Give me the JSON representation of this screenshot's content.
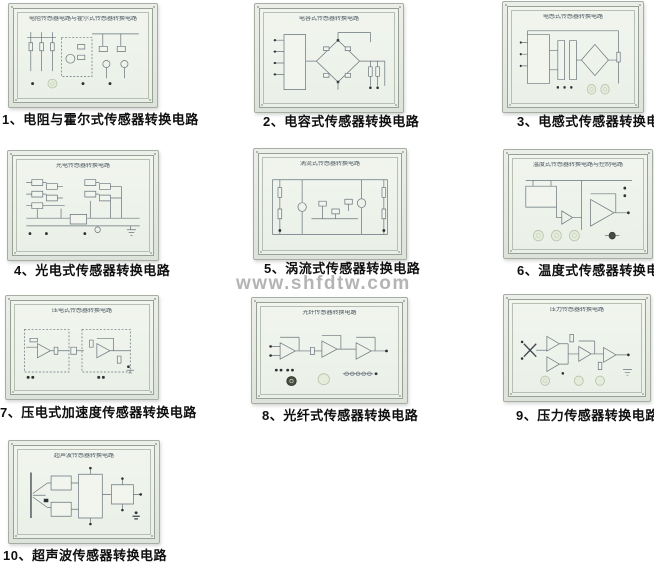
{
  "page": {
    "watermark": "www.shfdtw.com",
    "background": "#ffffff"
  },
  "colors": {
    "panel_frame": "#e3e8e0",
    "panel_face": "#eef2ec",
    "panel_border": "#97a195",
    "schematic_line": "#68737c",
    "caption_text": "#0f0f0f",
    "watermark_text": "#b4b4b4",
    "knob_fill": "#e6ecdb",
    "dark_knob_fill": "#474d41",
    "terminal_dot": "#2e3237"
  },
  "panels": [
    {
      "num": 1,
      "title": "电阻传感器电路与霍尔式传感器转换电路",
      "label": "1、电阻与霍尔式传感器转换电路",
      "schematic": "resistance-hall-circuit"
    },
    {
      "num": 2,
      "title": "电容式传感器转换电路",
      "label": "2、电容式传感器转换电路",
      "schematic": "capacitive-bridge-circuit"
    },
    {
      "num": 3,
      "title": "电感式传感器转换电路",
      "label": "3、电感式传感器转换电路",
      "schematic": "inductive-bridge-circuit"
    },
    {
      "num": 4,
      "title": "光电传感器转换电路",
      "label": "4、光电式传感器转换电路",
      "schematic": "photoelectric-gate-circuit"
    },
    {
      "num": 5,
      "title": "涡流式传感器转换电路",
      "label": "5、涡流式传感器转换电路",
      "schematic": "eddy-current-circuit"
    },
    {
      "num": 6,
      "title": "温度式传感器转换电路与控制电路",
      "label": "6、温度式传感器转换电路",
      "schematic": "temperature-control-circuit"
    },
    {
      "num": 7,
      "title": "压电式传感器转换电路",
      "label": "7、压电式加速度传感器转换电路",
      "schematic": "piezoelectric-amp-circuit"
    },
    {
      "num": 8,
      "title": "光纤传感器转换电路",
      "label": "8、光纤式传感器转换电路",
      "schematic": "fiber-optic-amp-circuit"
    },
    {
      "num": 9,
      "title": "压力传感器转换电路",
      "label": "9、压力传感器转换电路",
      "schematic": "pressure-amp-circuit"
    },
    {
      "num": 10,
      "title": "超声波传感器转换电路",
      "label": "10、超声波传感器转换电路",
      "schematic": "ultrasonic-block-diagram"
    }
  ]
}
